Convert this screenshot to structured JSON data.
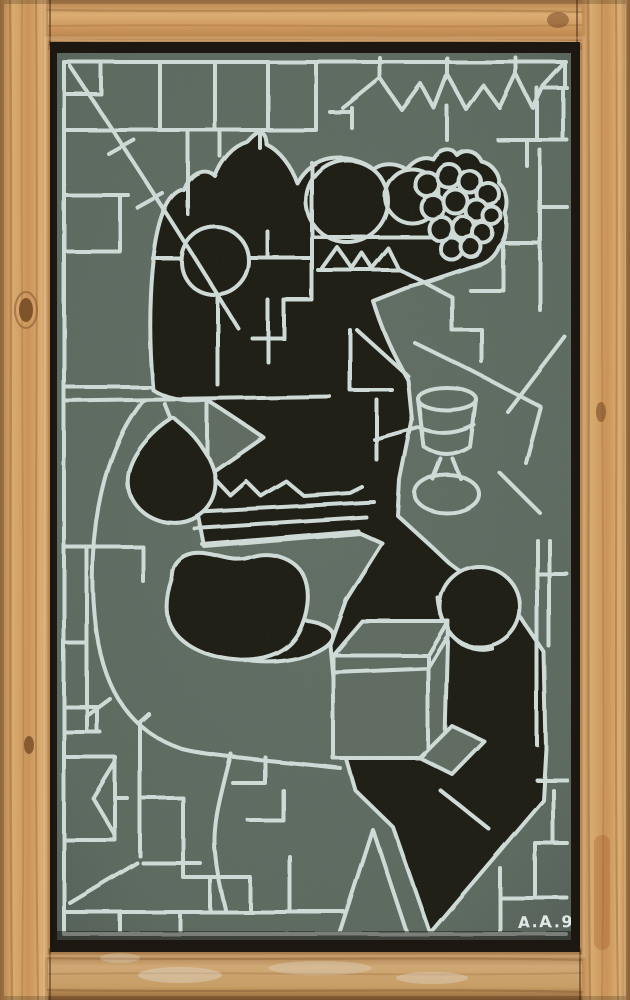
{
  "artwork": {
    "signature": "A.A.95",
    "kind": "abstract cubist still-life painting, photographed in a pine wood frame",
    "depicted_objects": [
      "black fruit bowl with pear, apples and grape cluster",
      "black pear",
      "black apple on saucer",
      "white-outline wine goblet",
      "grey open box on black drape",
      "round black fruit",
      "round table arc",
      "geometric white line lattice with zigzag border"
    ]
  },
  "palette": {
    "panel": "#5a665c",
    "line": "#ccd8d4",
    "paint-black": "#17120e",
    "signature-color": "#dfe8e5",
    "wood-light": "#dcae74",
    "wood-mid": "#c89258",
    "wood-dark": "#a07040",
    "shadow-gap": "#1d1712"
  }
}
